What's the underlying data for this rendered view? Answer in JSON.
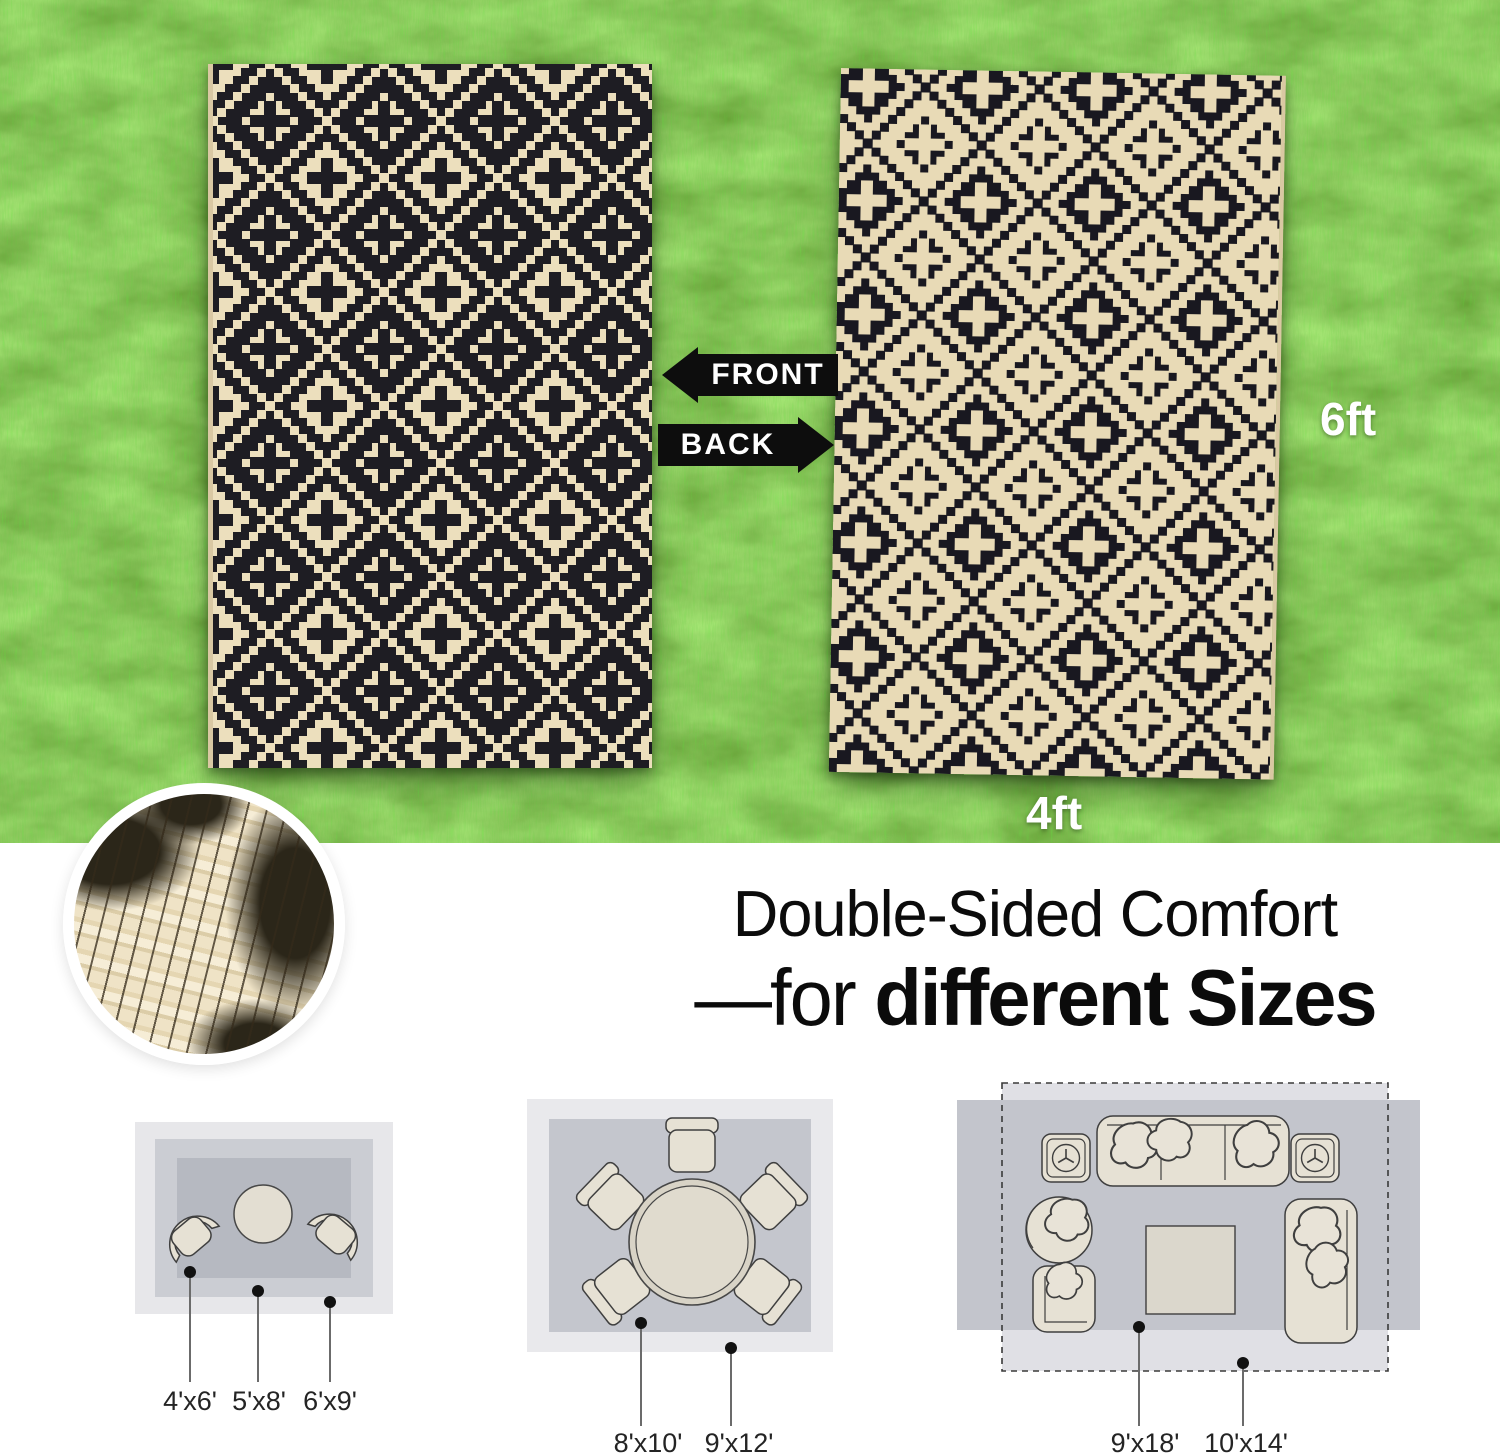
{
  "photo": {
    "front_label": "FRONT",
    "back_label": "BACK",
    "height_label": "6ft",
    "width_label": "4ft"
  },
  "headline": {
    "line1": "Double-Sided Comfort",
    "line2_prefix": "—for ",
    "line2_emphasis": "different Sizes"
  },
  "diagrams": {
    "small": {
      "sizes": [
        "4'x6'",
        "5'x8'",
        "6'x9'"
      ]
    },
    "medium": {
      "sizes": [
        "8'x10'",
        "9'x12'"
      ]
    },
    "large": {
      "sizes": [
        "9'x18'",
        "10'x14'"
      ]
    }
  },
  "colors": {
    "grass_green": "#4f9d27",
    "rug_black": "#1e1d23",
    "rug_cream": "#ecdfbd",
    "arrow_black": "#0d0d0d",
    "dimension_label_white": "#ffffff",
    "headline_text": "#0b0b0b",
    "diagram_light_gray": "#e7e7ea",
    "diagram_mid_gray": "#c4c6cd",
    "diagram_dark_gray": "#b6b9c1",
    "furniture_fill": "#e6e1d4",
    "furniture_outline": "#3f3f3f"
  }
}
